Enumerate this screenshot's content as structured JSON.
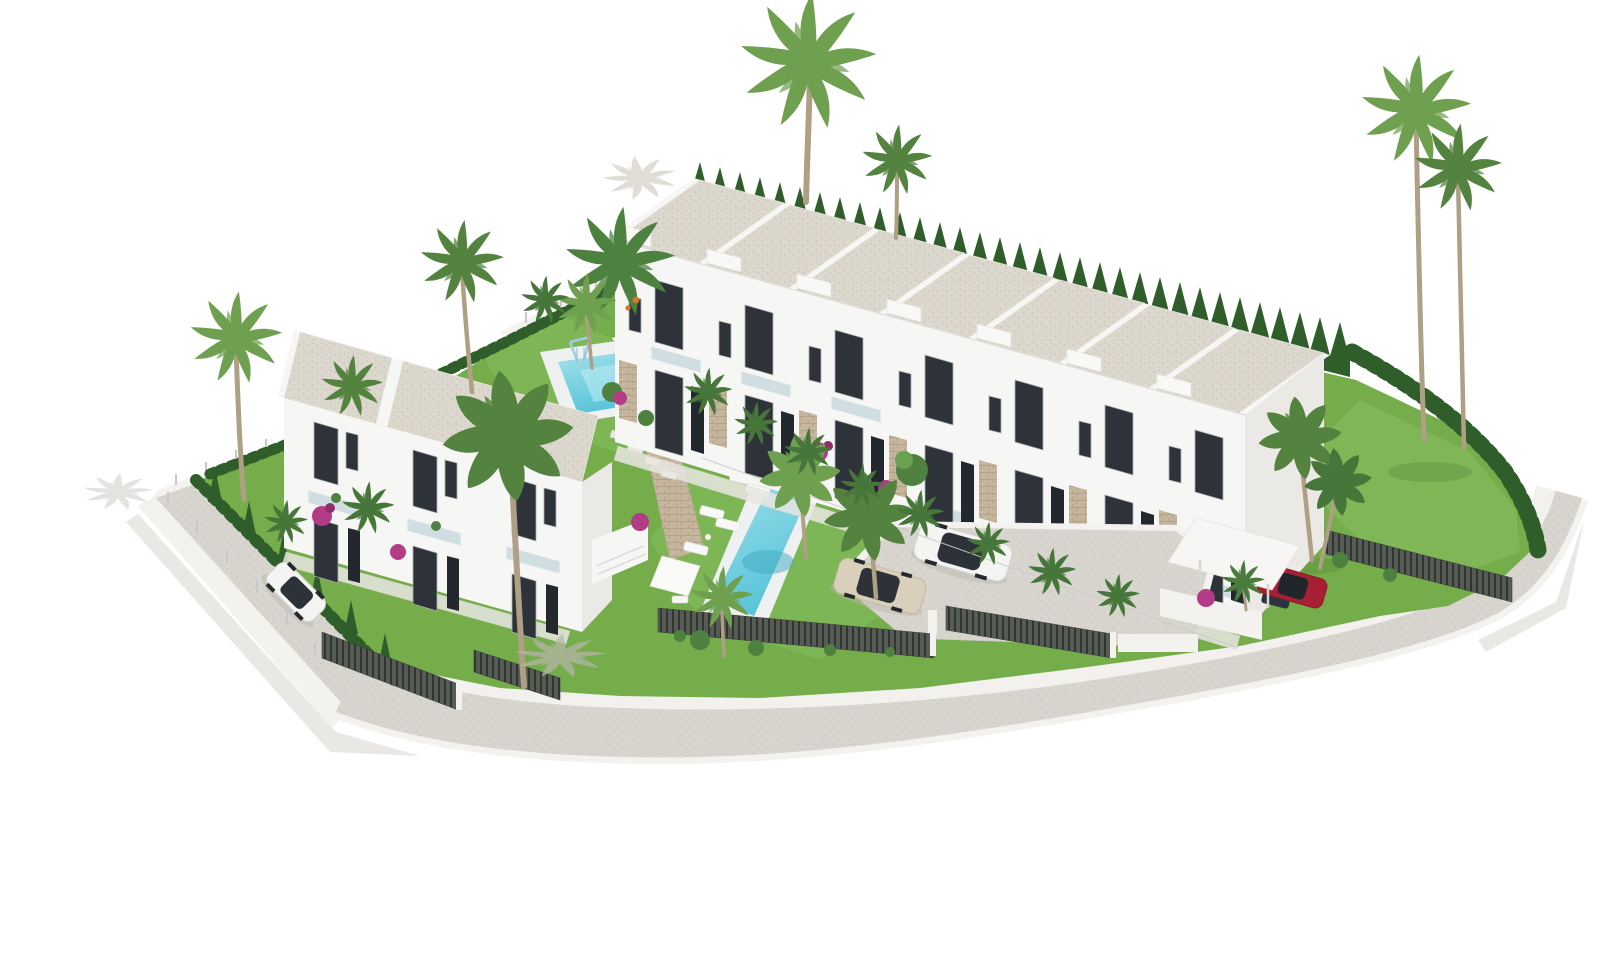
{
  "meta": {
    "title": "Aerial 3D architectural rendering of a white Mediterranean townhouse development with pools, palm trees, gardens and a parking court on a white background",
    "style": "photorealistic CGI, isometric aerial view",
    "background_color": "#ffffff"
  },
  "palette": {
    "background": "#ffffff",
    "wall_white": "#f6f6f4",
    "wall_shade": "#eae9e5",
    "roof_base": "#ddd8ce",
    "roof_speckle": "#c9c2b5",
    "window_glass": "#2d3339",
    "window_frame": "#a9afb3",
    "balcony_glass": "#c6d8de",
    "road_base": "#d8d5cf",
    "road_speckle": "#c7c4bd",
    "curb_white": "#f3f2ef",
    "grass": "#76ad4b",
    "grass_light": "#8ac262",
    "grass_shadow": "#3e6d2f",
    "hedge_dark": "#2f5e2b",
    "shrub_green": "#4e8040",
    "palm_bright": "#6fa050",
    "palm_dark": "#46763a",
    "palm_mid": "#54823f",
    "trunk": "#ae9f85",
    "pool_deep": "#56c3d8",
    "pool_light": "#a5e3ec",
    "pool_deck": "#eff1f0",
    "fence_dark": "#51564f",
    "fence_slat": "#30352f",
    "stone": "#c6b69e",
    "stone_line": "#ab9b83",
    "bougainvillea": "#b23c86",
    "car_red": "#a61f33",
    "car_beige": "#d9cfba",
    "car_white": "#f4f4f2",
    "car_glass": "#2c3237",
    "shadow_soft": "#e9e8e5",
    "shadow_road": "#b8b5ae"
  },
  "scene": {
    "buildings": [
      {
        "id": "townhouse-row",
        "label": "Terraced townhouse row",
        "units": 7,
        "storeys": 2,
        "roof": "flat light-gravel roofs with white parapets",
        "facade": "white render, dark full-height windows, stone accents, glass balconies"
      },
      {
        "id": "corner-block",
        "label": "Corner townhouse block",
        "units": 3,
        "storeys": 2,
        "facade": "white render, glass balconies with planters"
      }
    ],
    "pools": [
      {
        "id": "main-pool",
        "label": "Communal lap pool",
        "loungers": 5,
        "umbrellas": 1
      },
      {
        "id": "kids-pool",
        "label": "Kids pool terrace",
        "features": [
          "swing set",
          "shade sail",
          "sun loungers",
          "two figures"
        ]
      }
    ],
    "parking": {
      "label": "Residents parking court",
      "visible_cars": 2,
      "extras": [
        "white carport",
        "red car",
        "dark car"
      ]
    },
    "vehicles": [
      {
        "id": "white-hatchback",
        "color": "white",
        "location": "west access road"
      },
      {
        "id": "white-sedan",
        "color": "white",
        "location": "parking court"
      },
      {
        "id": "beige-sedan",
        "color": "beige",
        "location": "parking court"
      },
      {
        "id": "red-car",
        "color": "red",
        "location": "east carport"
      }
    ],
    "vegetation": {
      "tall_palms": 7,
      "fan_palms": 14,
      "cypress_hedges": 5,
      "bougainvillea_clusters": 7,
      "banana_plants": 1,
      "lawns": 3
    },
    "site": {
      "roads": [
        "west access road",
        "curved south perimeter road"
      ],
      "walls": "white rendered retaining walls with slim posts",
      "fences": "dark slatted privacy fence sections",
      "paths": "stepping-stone walkways"
    }
  }
}
